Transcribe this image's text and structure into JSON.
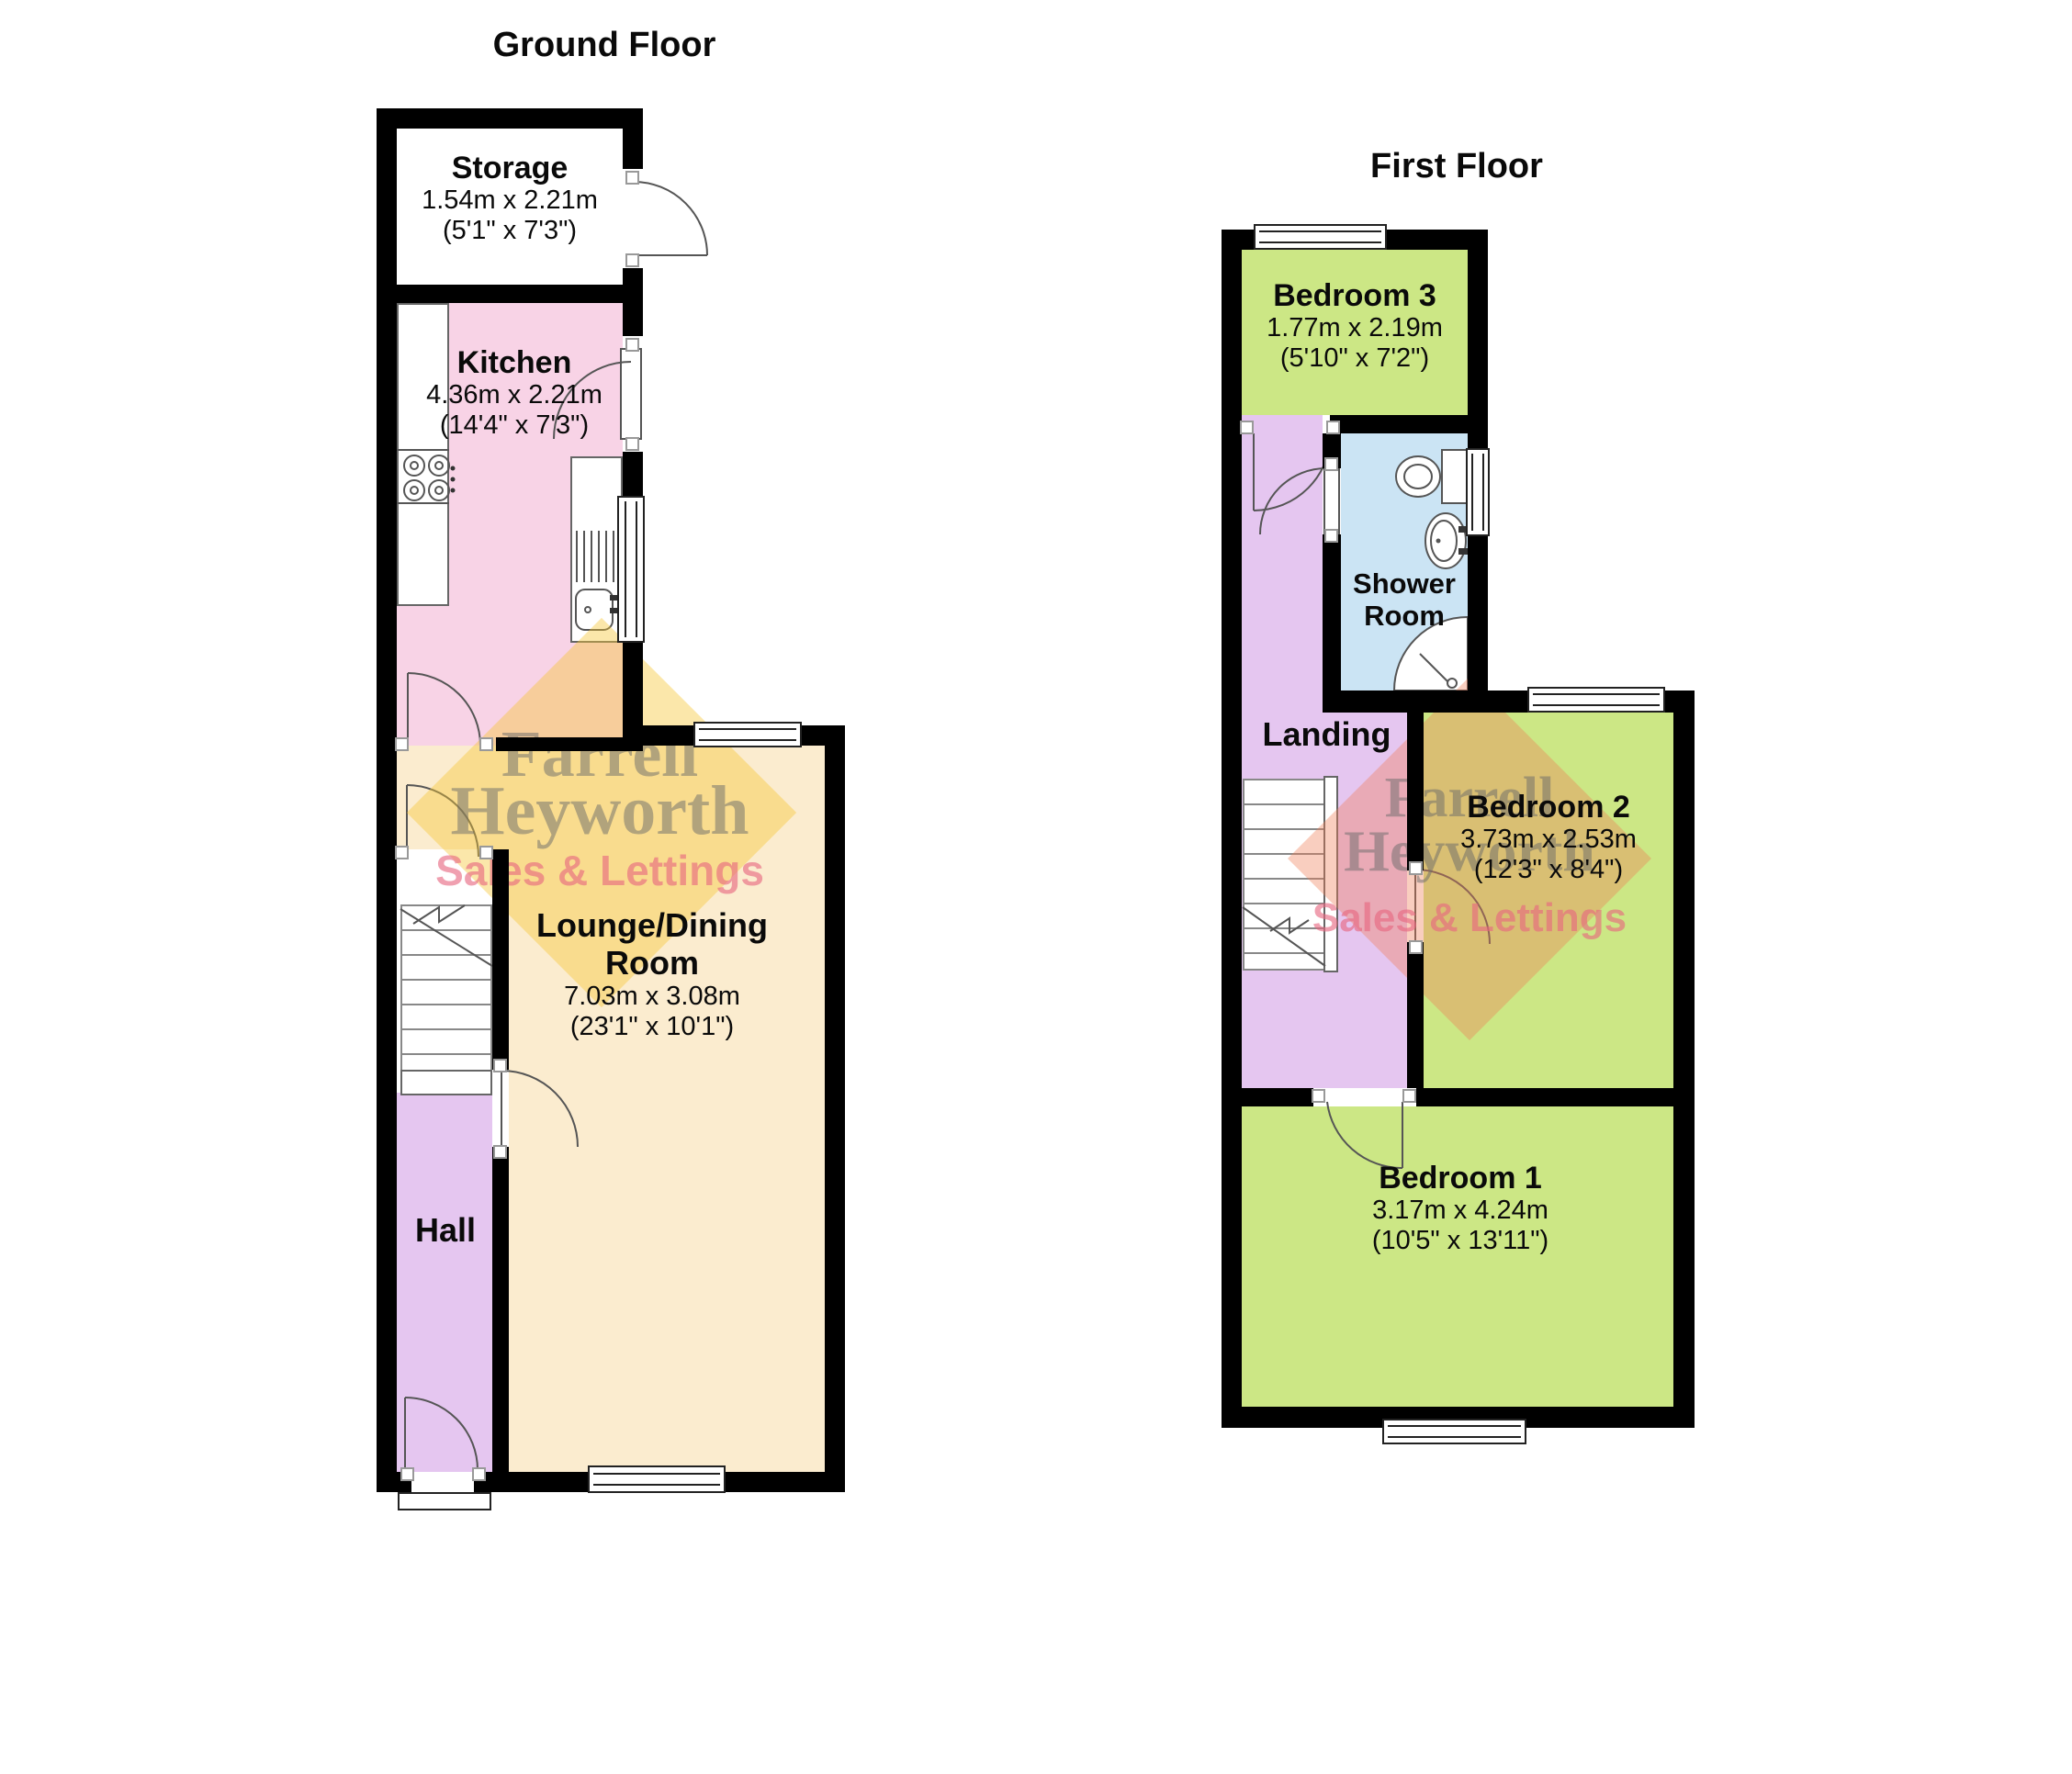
{
  "watermark": {
    "name_line1": "Farrell",
    "name_line2": "Heyworth",
    "tagline": "Sales & Lettings"
  },
  "ground_floor": {
    "title": "Ground Floor",
    "rooms": {
      "storage": {
        "name": "Storage",
        "metric": "1.54m x 2.21m",
        "imperial": "(5'1\" x 7'3\")"
      },
      "kitchen": {
        "name": "Kitchen",
        "metric": "4.36m x 2.21m",
        "imperial": "(14'4\" x 7'3\")"
      },
      "lounge_dining": {
        "name": "Lounge/Dining Room",
        "metric": "7.03m x 3.08m",
        "imperial": "(23'1\" x 10'1\")"
      },
      "hall": {
        "name": "Hall"
      }
    }
  },
  "first_floor": {
    "title": "First Floor",
    "rooms": {
      "bedroom3": {
        "name": "Bedroom 3",
        "metric": "1.77m x 2.19m",
        "imperial": "(5'10\" x 7'2\")"
      },
      "shower_room": {
        "name": "Shower Room"
      },
      "landing": {
        "name": "Landing"
      },
      "bedroom2": {
        "name": "Bedroom 2",
        "metric": "3.73m x 2.53m",
        "imperial": "(12'3\" x 8'4\")"
      },
      "bedroom1": {
        "name": "Bedroom 1",
        "metric": "3.17m x 4.24m",
        "imperial": "(10'5\" x 13'11\")"
      }
    }
  },
  "colors": {
    "wall": "#000000",
    "kitchen": "#f8d3e6",
    "lounge": "#fbeccf",
    "hall": "#e5c6f0",
    "landing": "#e5c6f0",
    "bedroom": "#cce785",
    "shower": "#cbe4f4",
    "watermark_gold": "rgba(246,198,52,0.42)",
    "watermark_salmon": "rgba(238,126,88,0.38)",
    "watermark_text": "rgba(105,105,105,0.5)",
    "watermark_tagline": "rgba(230,102,128,0.62)"
  }
}
